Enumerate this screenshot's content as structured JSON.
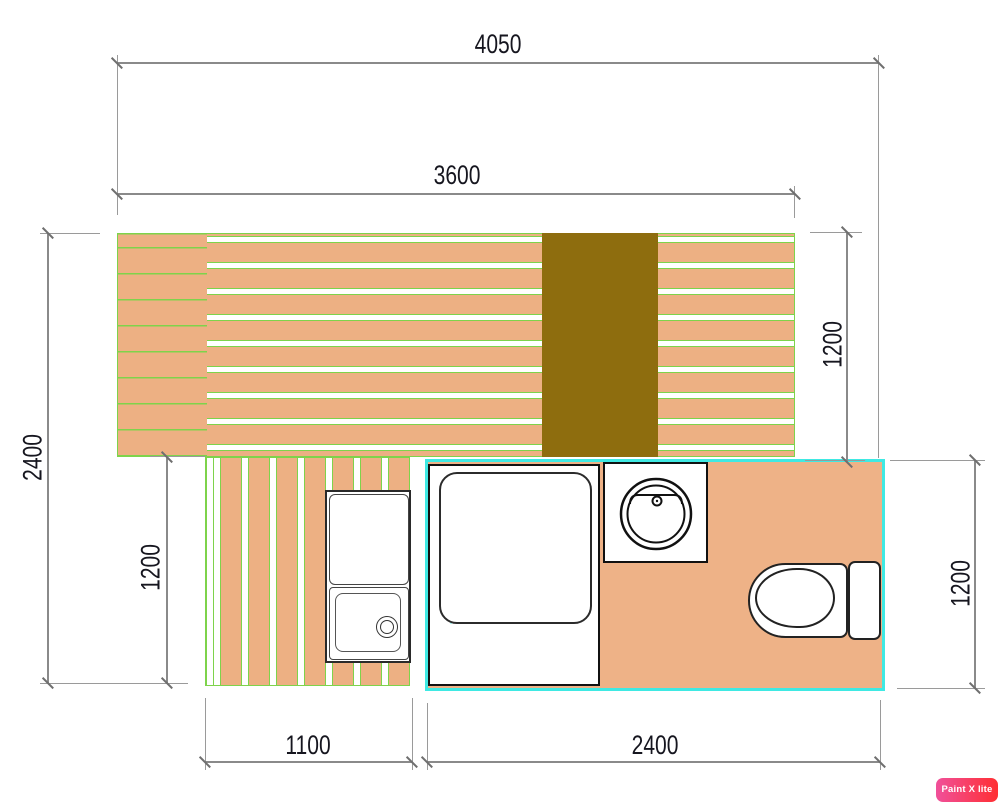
{
  "watermark": {
    "label": "Paint X lite"
  },
  "dimensions_mm": {
    "overall_width": "4050",
    "deck_width": "3600",
    "overall_depth": "2400",
    "lower_left_depth": "1200",
    "deck_right_depth": "1200",
    "bathroom_depth": "1200",
    "walkway_width": "1100",
    "bathroom_width": "2400"
  },
  "fixtures": {
    "shower": "shower-tray with shower-head and spray lines",
    "basin": "round wash basin with faucet",
    "toilet": "toilet bowl with cistern",
    "kitchen_sink": "counter with square sink and drain"
  },
  "colors": {
    "plank_tan": "#edb083",
    "plank_gap_green": "#7ed34b",
    "olive_runner": "#8e6d0e",
    "bathroom_wall_cyan": "#3fe9e3",
    "spray_red": "#f2473f",
    "dimension_gray": "#8a8a8a",
    "dimension_text": "#16161f"
  }
}
